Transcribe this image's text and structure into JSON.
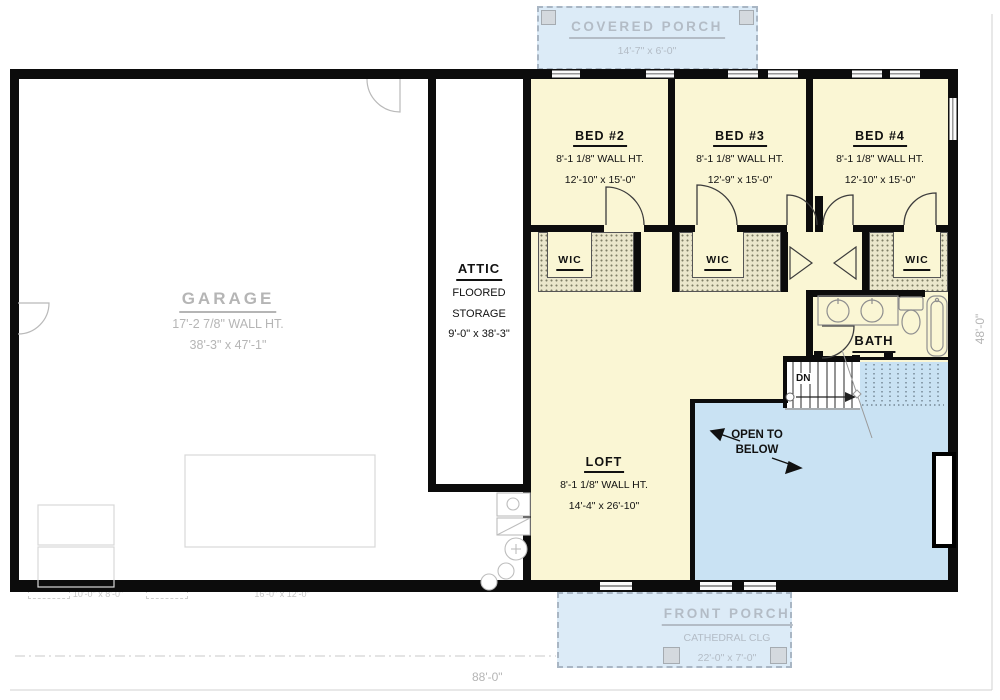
{
  "plan": {
    "covered_porch": {
      "name": "COVERED PORCH",
      "dims": "14'-7\" x 6'-0\""
    },
    "bed2": {
      "name": "BED #2",
      "wall_ht": "8'-1 1/8\" WALL HT.",
      "dims": "12'-10\" x 15'-0\""
    },
    "bed3": {
      "name": "BED #3",
      "wall_ht": "8'-1 1/8\" WALL HT.",
      "dims": "12'-9\" x 15'-0\""
    },
    "bed4": {
      "name": "BED #4",
      "wall_ht": "8'-1 1/8\" WALL HT.",
      "dims": "12'-10\" x 15'-0\""
    },
    "wic": {
      "name": "WIC"
    },
    "bath": {
      "name": "BATH"
    },
    "attic": {
      "name": "ATTIC",
      "line2": "FLOORED",
      "line3": "STORAGE",
      "dims": "9'-0\" x 38'-3\""
    },
    "garage": {
      "name": "GARAGE",
      "wall_ht": "17'-2 7/8\" WALL HT.",
      "dims": "38'-3\" x 47'-1\""
    },
    "loft": {
      "name": "LOFT",
      "wall_ht": "8'-1 1/8\" WALL HT.",
      "dims": "14'-4\" x 26'-10\""
    },
    "open_below": {
      "line1": "OPEN TO",
      "line2": "BELOW"
    },
    "front_porch": {
      "name": "FRONT PORCH",
      "line2": "CATHEDRAL CLG",
      "dims": "22'-0\" x 7'-0\""
    },
    "stairs": {
      "label": "DN"
    },
    "dims": {
      "overall_width": "88'-0\"",
      "overall_height": "48'-0\"",
      "garage_door_small": "10'-0\" x 8'-0\"",
      "garage_door_large": "16'-0\" x 12'-0\""
    }
  },
  "colors": {
    "wall": "#0c0c0c",
    "room_fill": "#faf6d4",
    "porch_fill": "#dcebf7",
    "open_below_fill": "#c9e2f3",
    "hatch_fill": "#eae6cb",
    "muted_text": "#b5b5b5",
    "porch_text": "#b3bcc6"
  }
}
